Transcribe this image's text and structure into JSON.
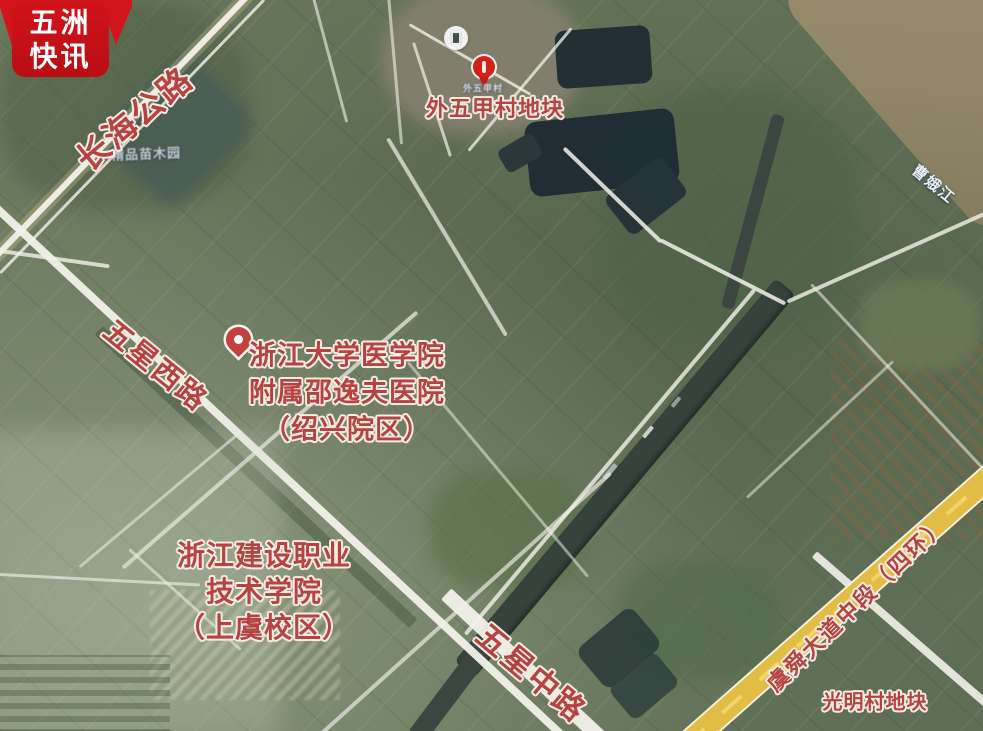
{
  "badge": {
    "line1": "五洲",
    "line2": "快讯"
  },
  "labels": {
    "village_plot": "外五甲村地块",
    "village_small": "外五甲村",
    "place_faint": "精品苗木园",
    "river": "曹娥江",
    "guangming_plot": "光明村地块",
    "hospital": {
      "l1": "浙江大学医学院",
      "l2": "附属邵逸夫医院",
      "l3": "（绍兴院区）"
    },
    "college": {
      "l1": "浙江建设职业",
      "l2": "技术学院",
      "l3": "（上虞校区）"
    },
    "roads": {
      "changhai": "长海公路",
      "wuxing_west": "五星西路",
      "wuxing_middle": "五星中路",
      "yushun": "虞舜大道中段（四环）"
    }
  },
  "colors": {
    "accent_red": "#c81016",
    "label_red": "#b54341",
    "road_yellow": "#e2bd45",
    "road_white": "#f2f1e9",
    "canal_water": "#36423c",
    "pond_water": "#1c2a33",
    "river_water": "#94886a"
  }
}
